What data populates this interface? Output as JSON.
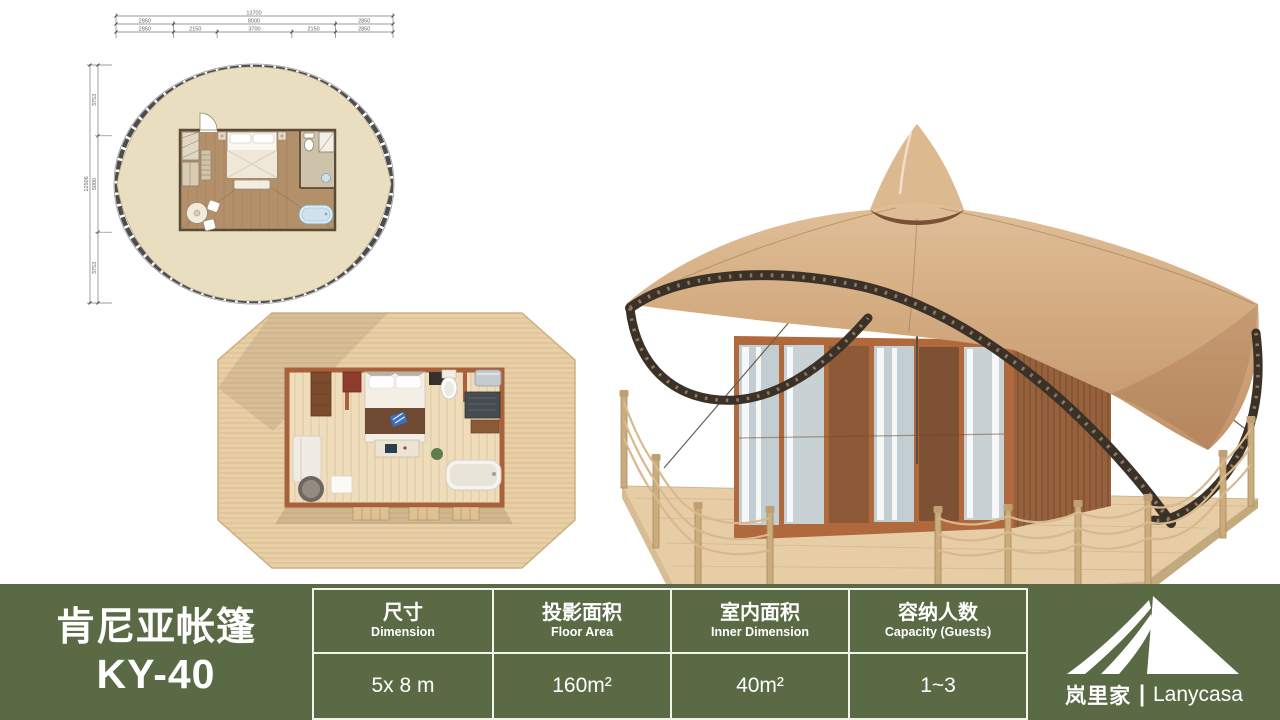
{
  "colors": {
    "table_green": "#5a6a45",
    "divider_white": "#f2f4ec",
    "canopy_tan": "#d5ad83",
    "plan_fabric_beige": "#e9dec0",
    "plan_wood": "#b3906a",
    "deck_wood": "#e8cfa5",
    "truss_dark": "#3b3127"
  },
  "floor_plan": {
    "dims_top": {
      "total": "13700",
      "row2": [
        "2850",
        "8000",
        "2850"
      ],
      "row3": [
        "2850",
        "2150",
        "3700",
        "2150",
        "2850"
      ]
    },
    "dims_left": {
      "total": "12506",
      "segments": [
        "3753",
        "5000",
        "3753"
      ]
    }
  },
  "spec_table": {
    "title_cn": "肯尼亚帐篷",
    "title_model": "KY-40",
    "columns": [
      {
        "label_cn": "尺寸",
        "label_en": "Dimension",
        "value": "5x 8 m"
      },
      {
        "label_cn": "投影面积",
        "label_en": "Floor Area",
        "value": "160m²"
      },
      {
        "label_cn": "室内面积",
        "label_en": "Inner Dimension",
        "value": "40m²"
      },
      {
        "label_cn": "容纳人数",
        "label_en": "Capacity (Guests)",
        "value": "1~3"
      }
    ],
    "brand": {
      "name_cn": "岚里家",
      "separator": "|",
      "name_en": "Lanycasa"
    }
  }
}
